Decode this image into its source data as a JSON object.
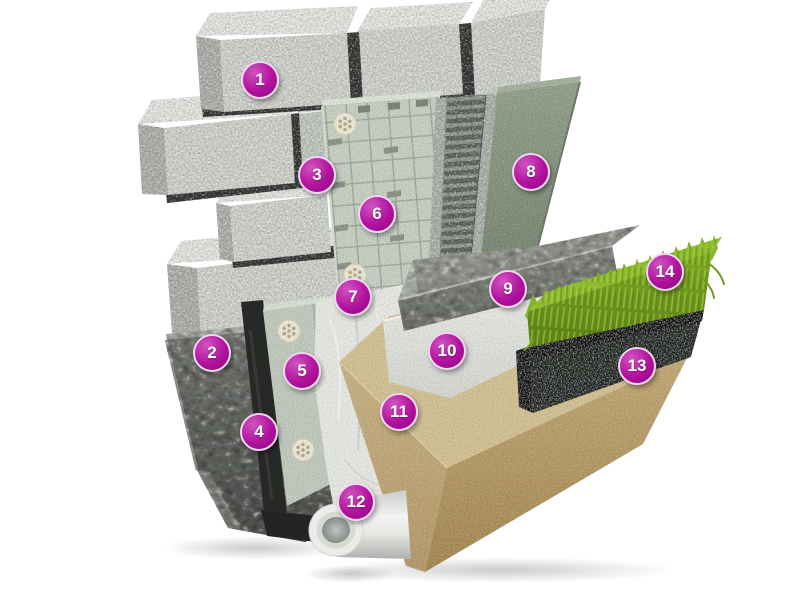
{
  "canvas": {
    "width": 798,
    "height": 612,
    "background": "#ffffff"
  },
  "diagram": {
    "kind": "3d-cutaway-construction-detail",
    "hotspot_style": {
      "fill": "#b2119e",
      "ring": "#f1d7ee",
      "text_color": "#ffffff",
      "diameter_px": 38
    },
    "hotspots": [
      {
        "label": "1",
        "x": 260,
        "y": 80
      },
      {
        "label": "2",
        "x": 212,
        "y": 353
      },
      {
        "label": "3",
        "x": 317,
        "y": 175
      },
      {
        "label": "4",
        "x": 259,
        "y": 432
      },
      {
        "label": "5",
        "x": 302,
        "y": 371
      },
      {
        "label": "6",
        "x": 377,
        "y": 214
      },
      {
        "label": "7",
        "x": 353,
        "y": 297
      },
      {
        "label": "8",
        "x": 531,
        "y": 172
      },
      {
        "label": "9",
        "x": 508,
        "y": 289
      },
      {
        "label": "10",
        "x": 447,
        "y": 351
      },
      {
        "label": "11",
        "x": 399,
        "y": 412
      },
      {
        "label": "12",
        "x": 356,
        "y": 502
      },
      {
        "label": "13",
        "x": 637,
        "y": 366
      },
      {
        "label": "14",
        "x": 665,
        "y": 272
      }
    ],
    "palette": {
      "masonry_block": "#d5d8d3",
      "block_top": "#e9ebe7",
      "mortar_joint": "#3a3d3a",
      "foundation_concrete": "#6e716c",
      "bitumen_membrane": "#272927",
      "perimeter_insulation_board": "#c5ccc0",
      "fixing_dowel": "#efecdb",
      "protection_sheet": "#e9ebe6",
      "scored_insulation_board": "#cbd2c5",
      "drainage_panel": "#666b66",
      "render_coat": "#8d9a86",
      "concrete_slab": "#989c95",
      "foam_insulation": "#eef0ed",
      "sand_bed": "#cdb988",
      "drain_pipe": "#ebedea",
      "topsoil": "#1d201e",
      "grass": "#7cae27"
    }
  }
}
